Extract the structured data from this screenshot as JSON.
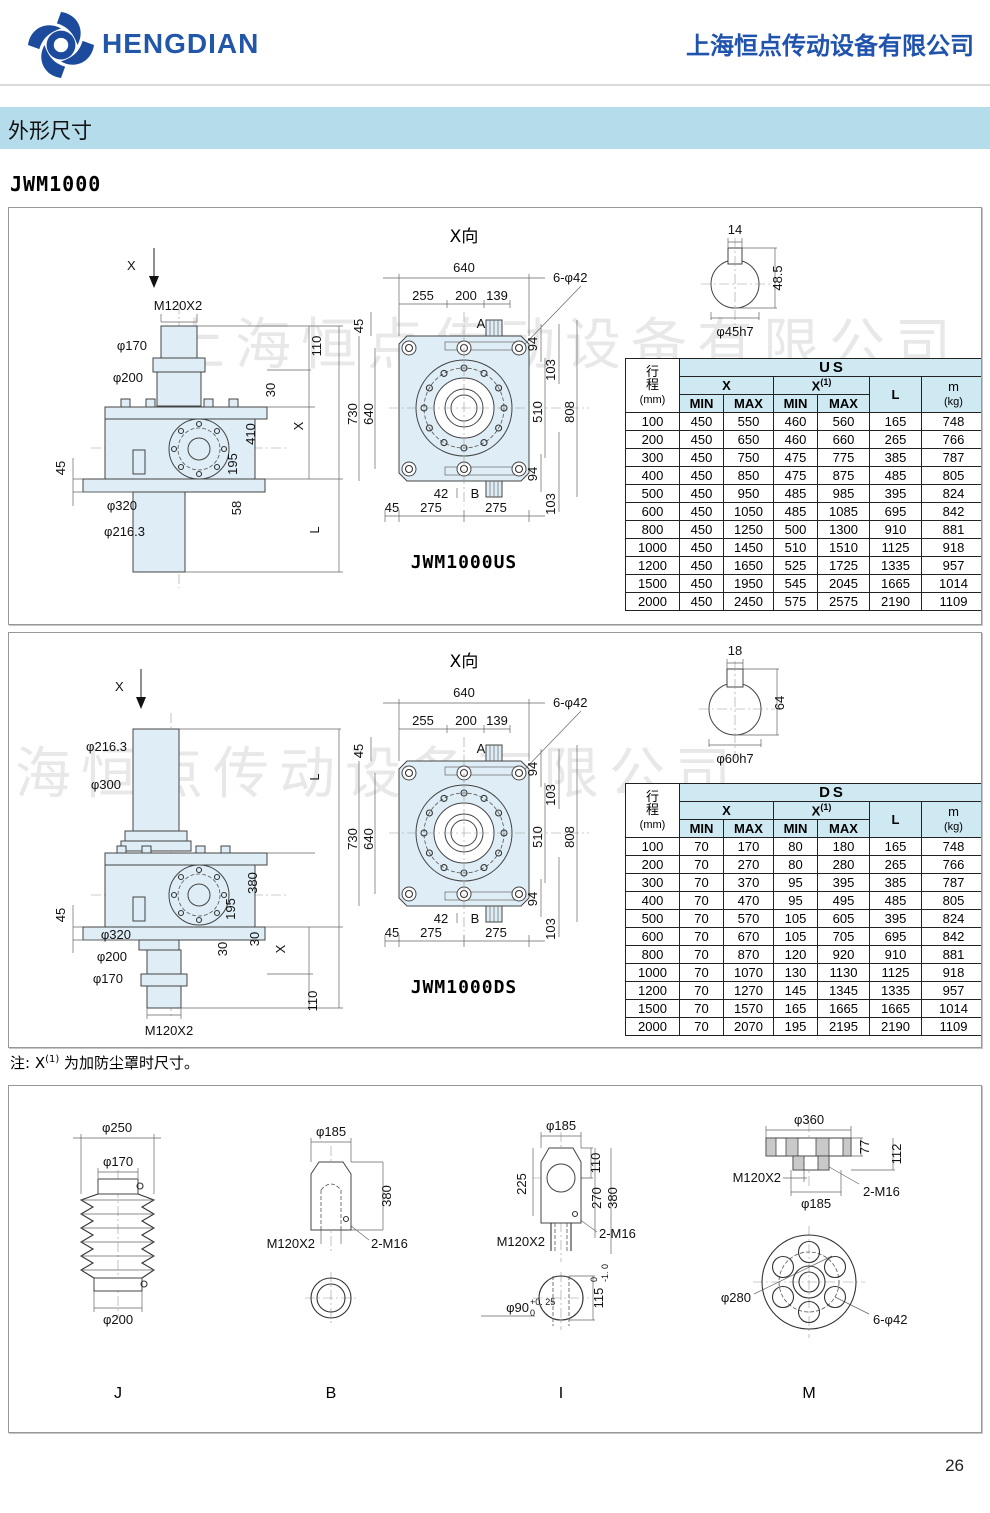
{
  "header": {
    "brand": "HENGDIAN",
    "company": "上海恒点传动设备有限公司"
  },
  "section_title": "外形尺寸",
  "model": "JWM1000",
  "watermark": "上海恒点传动设备有限公司",
  "note": {
    "prefix": "注: X",
    "sup": "(1)",
    "suffix": " 为加防尘罩时尺寸。"
  },
  "page_number": "26",
  "us": {
    "view_title": "X向",
    "caption": "JWM1000US",
    "side": {
      "x": "X",
      "thread": "M120X2",
      "d170": "φ170",
      "d200": "φ200",
      "d320": "φ320",
      "d216": "φ216.3",
      "dim45": "45",
      "dim110": "110",
      "dim30": "30",
      "dimX": "X",
      "dim410": "410",
      "dim195": "195",
      "dim58": "58",
      "dimL": "L"
    },
    "top": {
      "w640": "640",
      "w255": "255",
      "w200": "200",
      "w139": "139",
      "holes": "6-φ42",
      "a": "A",
      "b": "B",
      "l45": "45",
      "h730": "730",
      "h640": "640",
      "r94t": "94",
      "r103t": "103",
      "r510": "510",
      "r808": "808",
      "w42": "42",
      "b45": "45",
      "b275l": "275",
      "b275r": "275",
      "r94b": "94",
      "r103b": "103"
    },
    "shaft": {
      "key": "14",
      "height": "48.5",
      "dia": "φ45h7"
    },
    "table": {
      "c1a": "行",
      "c1b": "程",
      "c1c": "(mm)",
      "title": "US",
      "x": "X",
      "x1": "X",
      "x1_sup": "(1)",
      "min": "MIN",
      "max": "MAX",
      "l": "L",
      "m": "m",
      "m_unit": "(kg)",
      "rows": [
        [
          100,
          450,
          550,
          460,
          560,
          165,
          748
        ],
        [
          200,
          450,
          650,
          460,
          660,
          265,
          766
        ],
        [
          300,
          450,
          750,
          475,
          775,
          385,
          787
        ],
        [
          400,
          450,
          850,
          475,
          875,
          485,
          805
        ],
        [
          500,
          450,
          950,
          485,
          985,
          395,
          824
        ],
        [
          600,
          450,
          1050,
          485,
          1085,
          695,
          842
        ],
        [
          800,
          450,
          1250,
          500,
          1300,
          910,
          881
        ],
        [
          1000,
          450,
          1450,
          510,
          1510,
          1125,
          918
        ],
        [
          1200,
          450,
          1650,
          525,
          1725,
          1335,
          957
        ],
        [
          1500,
          450,
          1950,
          545,
          2045,
          1665,
          1014
        ],
        [
          2000,
          450,
          2450,
          575,
          2575,
          2190,
          1109
        ]
      ]
    }
  },
  "ds": {
    "view_title": "X向",
    "caption": "JWM1000DS",
    "side": {
      "x": "X",
      "d216": "φ216.3",
      "d300": "φ300",
      "dim45": "45",
      "d320": "φ320",
      "d200": "φ200",
      "d170": "φ170",
      "thread": "M120X2",
      "dimL": "L",
      "dim380": "380",
      "dim195": "195",
      "dim30a": "30",
      "dim30b": "30",
      "dimX": "X",
      "dim110": "110"
    },
    "top": {
      "w640": "640",
      "w255": "255",
      "w200": "200",
      "w139": "139",
      "holes": "6-φ42",
      "a": "A",
      "b": "B",
      "l45": "45",
      "h730": "730",
      "h640": "640",
      "r94t": "94",
      "r103t": "103",
      "r510": "510",
      "r808": "808",
      "w42": "42",
      "b45": "45",
      "b275l": "275",
      "b275r": "275",
      "r94b": "94",
      "r103b": "103"
    },
    "shaft": {
      "key": "18",
      "height": "64",
      "dia": "φ60h7"
    },
    "table": {
      "c1a": "行",
      "c1b": "程",
      "c1c": "(mm)",
      "title": "DS",
      "x": "X",
      "x1": "X",
      "x1_sup": "(1)",
      "min": "MIN",
      "max": "MAX",
      "l": "L",
      "m": "m",
      "m_unit": "(kg)",
      "rows": [
        [
          100,
          70,
          170,
          80,
          180,
          165,
          748
        ],
        [
          200,
          70,
          270,
          80,
          280,
          265,
          766
        ],
        [
          300,
          70,
          370,
          95,
          395,
          385,
          787
        ],
        [
          400,
          70,
          470,
          95,
          495,
          485,
          805
        ],
        [
          500,
          70,
          570,
          105,
          605,
          395,
          824
        ],
        [
          600,
          70,
          670,
          105,
          705,
          695,
          842
        ],
        [
          800,
          70,
          870,
          120,
          920,
          910,
          881
        ],
        [
          1000,
          70,
          1070,
          130,
          1130,
          1125,
          918
        ],
        [
          1200,
          70,
          1270,
          145,
          1345,
          1335,
          957
        ],
        [
          1500,
          70,
          1570,
          165,
          1665,
          1665,
          1014
        ],
        [
          2000,
          70,
          2070,
          195,
          2195,
          2190,
          1109
        ]
      ]
    }
  },
  "details": {
    "j": {
      "label": "J",
      "d250": "φ250",
      "d170": "φ170",
      "d200": "φ200"
    },
    "b": {
      "label": "B",
      "d185": "φ185",
      "h380": "380",
      "thread": "M120X2",
      "tap": "2-M16"
    },
    "i": {
      "label": "I",
      "d185": "φ185",
      "h110": "110",
      "h225": "225",
      "h270": "270",
      "h380": "380",
      "thread": "M120X2",
      "tap": "2-M16",
      "d90": "φ90",
      "d90_sup": "+0. 25",
      "d90_sub": "0",
      "h115": "115",
      "h115_sup": "0",
      "h115_sub": "-1. 0"
    },
    "m": {
      "label": "M",
      "d360": "φ360",
      "h77": "77",
      "h112": "112",
      "thread": "M120X2",
      "d185": "φ185",
      "tap": "2-M16",
      "d280": "φ280",
      "holes": "6-φ42"
    }
  }
}
